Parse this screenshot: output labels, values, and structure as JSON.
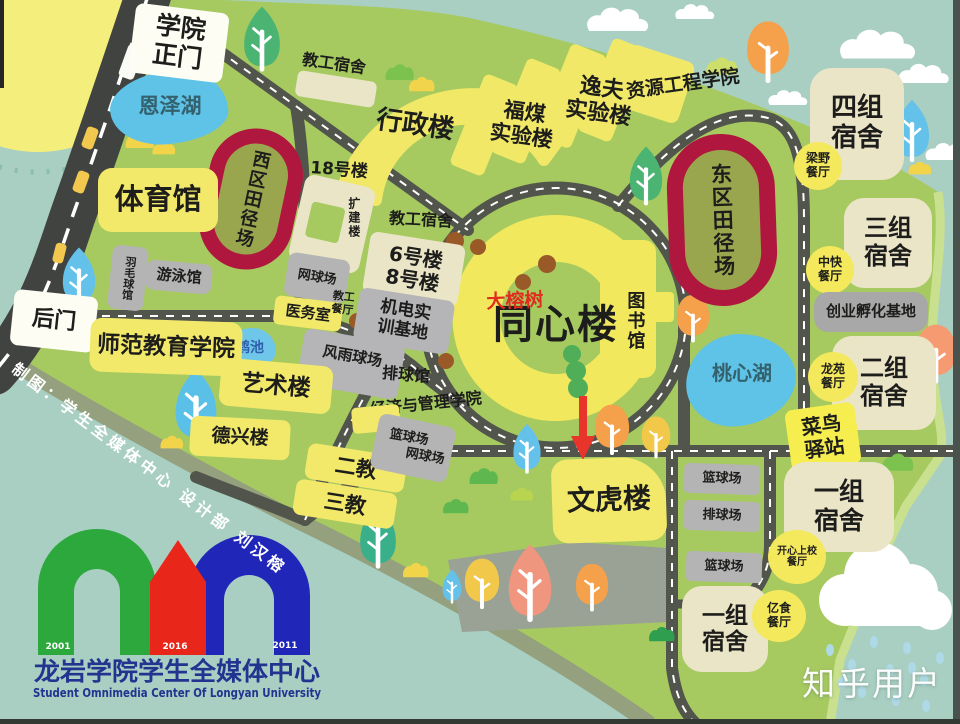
{
  "signs": {
    "main_gate": "学院\n正门",
    "back_gate": "后门"
  },
  "lakes": {
    "enze": "恩泽湖",
    "taoxin": "桃心湖",
    "hechi": "鹤池"
  },
  "stadiums": {
    "west": "西区田径场",
    "east": "东区田径场"
  },
  "buildings": {
    "gym": "体育馆",
    "admin": "行政楼",
    "staff_dorm_top": "教工宿舍",
    "b18": "18号楼",
    "extension": "扩建楼",
    "staff_dorm_mid": "教工宿舍",
    "fumei": "福煤\n实验楼",
    "yifu": "逸夫\n实验楼",
    "resource": "资源工程学院",
    "b6_8": "6号楼\n8号楼",
    "staff_canteen": "教工\n餐厅",
    "clinic": "医务室",
    "jidian": "机电实\n训基地",
    "fengyu": "风雨球场",
    "volleyball_hall": "排球馆",
    "econ": "经济与管理学院",
    "tongxin": "同心楼",
    "library": "图书馆",
    "normal_college": "师范教育学院",
    "art": "艺术楼",
    "dexing": "德兴楼",
    "erjiao": "二教",
    "sanjiao": "三教",
    "wenhu": "文虎楼",
    "badmin": "羽毛球馆",
    "swim": "游泳馆",
    "dorm4": "四组\n宿舍",
    "dorm3": "三组\n宿舍",
    "dorm2": "二组\n宿舍",
    "dorm1a": "一组\n宿舍",
    "dorm1b": "一组\n宿舍",
    "incubator": "创业孵化基地",
    "cainiao": "菜鸟\n驿站"
  },
  "courts": {
    "tennis_w": "网球场",
    "bball_mid": "篮球场",
    "tennis_mid": "网球场",
    "bball_1": "篮球场",
    "vball_1": "排球场",
    "bball_2": "篮球场"
  },
  "canteens": {
    "liangye": "梁野\n餐厅",
    "zhongkuai": "中快\n餐厅",
    "longyuan": "龙苑\n餐厅",
    "kaixin": "开心上校\n餐厅",
    "yishi": "亿食\n餐厅"
  },
  "annotations": {
    "banyan": "大榕树",
    "credit": "制图：学生全媒体中心  设计部  刘汉榕",
    "watermark": "知乎用户"
  },
  "logo": {
    "cn": "龙岩学院学生全媒体中心",
    "en": "Student Omnimedia Center Of Longyan University",
    "year_left": "2001",
    "year_mid": "2016",
    "year_right": "2011"
  },
  "colors": {
    "campus_green": "#a6ca60",
    "outside_teal": "#a9cfc3",
    "road_dark": "#4e5149",
    "track_red": "#b0173f",
    "building_yellow": "#f2e96a",
    "dorm_cream": "#ebe5c8",
    "court_gray": "#b4b4b4",
    "lake_blue": "#5fc2e7",
    "arrow_red": "#e8342a",
    "logo_green": "#2ca83c",
    "logo_red": "#e82619",
    "logo_blue": "#2026b8",
    "logo_navy": "#22348f"
  }
}
